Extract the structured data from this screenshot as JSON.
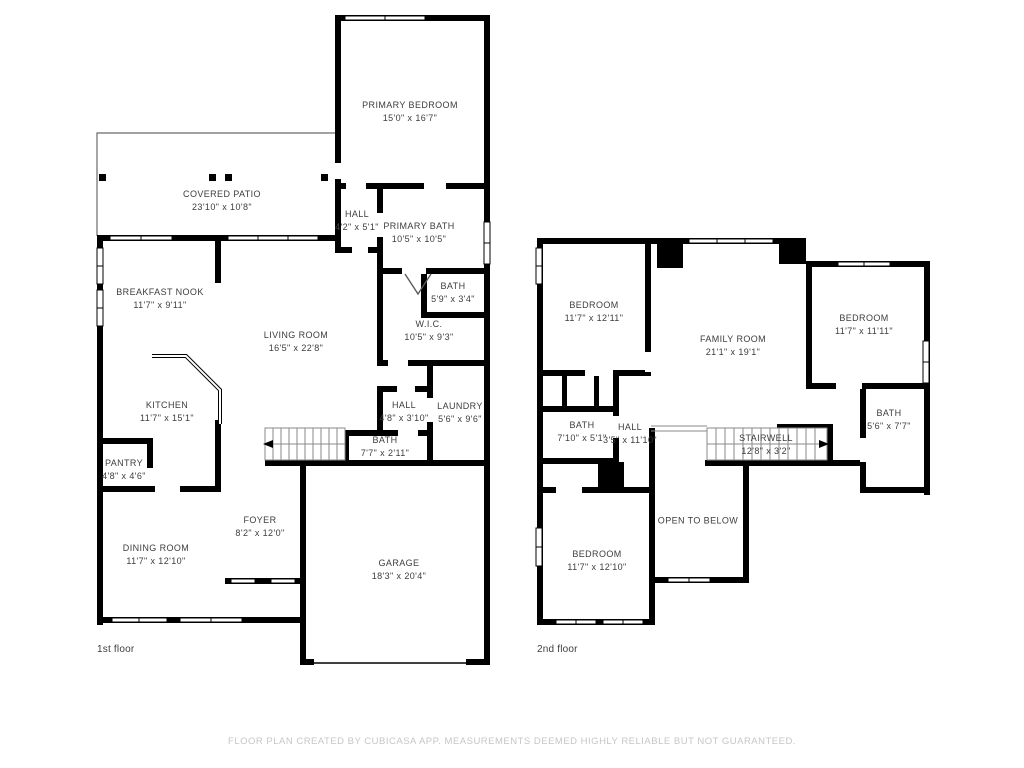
{
  "page": {
    "background": "#ffffff",
    "wall_color": "#000000",
    "label_color": "#3d3d3d",
    "footer_color": "#c6c6c6"
  },
  "footer": {
    "text": "FLOOR PLAN CREATED BY CUBICASA APP. MEASUREMENTS DEEMED HIGHLY RELIABLE BUT NOT GUARANTEED."
  },
  "floors": [
    {
      "label": "1st floor",
      "rooms": [
        {
          "name": "PRIMARY BEDROOM",
          "dims": "15'0\" x 16'7\"",
          "x": 410,
          "y": 112
        },
        {
          "name": "COVERED PATIO",
          "dims": "23'10\" x 10'8\"",
          "x": 222,
          "y": 201
        },
        {
          "name": "HALL",
          "dims": "4'2\" x 5'1\"",
          "x": 357,
          "y": 221
        },
        {
          "name": "PRIMARY BATH",
          "dims": "10'5\" x 10'5\"",
          "x": 419,
          "y": 233
        },
        {
          "name": "BATH",
          "dims": "5'9\" x 3'4\"",
          "x": 453,
          "y": 293
        },
        {
          "name": "W.I.C.",
          "dims": "10'5\" x 9'3\"",
          "x": 429,
          "y": 331
        },
        {
          "name": "BREAKFAST NOOK",
          "dims": "11'7\" x 9'11\"",
          "x": 160,
          "y": 299
        },
        {
          "name": "LIVING ROOM",
          "dims": "16'5\" x 22'8\"",
          "x": 296,
          "y": 342
        },
        {
          "name": "KITCHEN",
          "dims": "11'7\" x 15'1\"",
          "x": 167,
          "y": 412
        },
        {
          "name": "HALL",
          "dims": "4'8\" x 3'10\"",
          "x": 404,
          "y": 412
        },
        {
          "name": "LAUNDRY",
          "dims": "5'6\" x 9'6\"",
          "x": 460,
          "y": 413
        },
        {
          "name": "BATH",
          "dims": "7'7\" x 2'11\"",
          "x": 385,
          "y": 447
        },
        {
          "name": "PANTRY",
          "dims": "4'8\" x 4'6\"",
          "x": 124,
          "y": 470
        },
        {
          "name": "FOYER",
          "dims": "8'2\" x 12'0\"",
          "x": 260,
          "y": 527
        },
        {
          "name": "DINING ROOM",
          "dims": "11'7\" x 12'10\"",
          "x": 156,
          "y": 555
        },
        {
          "name": "GARAGE",
          "dims": "18'3\" x 20'4\"",
          "x": 399,
          "y": 570
        }
      ]
    },
    {
      "label": "2nd floor",
      "rooms": [
        {
          "name": "BEDROOM",
          "dims": "11'7\" x 12'11\"",
          "x": 594,
          "y": 312
        },
        {
          "name": "FAMILY ROOM",
          "dims": "21'1\" x 19'1\"",
          "x": 733,
          "y": 346
        },
        {
          "name": "BEDROOM",
          "dims": "11'7\" x 11'11\"",
          "x": 864,
          "y": 325
        },
        {
          "name": "BATH",
          "dims": "7'10\" x 5'1\"",
          "x": 582,
          "y": 432
        },
        {
          "name": "HALL",
          "dims": "3'5\" x 11'10\"",
          "x": 630,
          "y": 434
        },
        {
          "name": "BATH",
          "dims": "5'6\" x 7'7\"",
          "x": 889,
          "y": 420
        },
        {
          "name": "STAIRWELL",
          "dims": "12'8\" x 3'2\"",
          "x": 766,
          "y": 445
        },
        {
          "name": "OPEN TO BELOW",
          "dims": "",
          "x": 698,
          "y": 521
        },
        {
          "name": "BEDROOM",
          "dims": "11'7\" x 12'10\"",
          "x": 597,
          "y": 561
        }
      ]
    }
  ]
}
